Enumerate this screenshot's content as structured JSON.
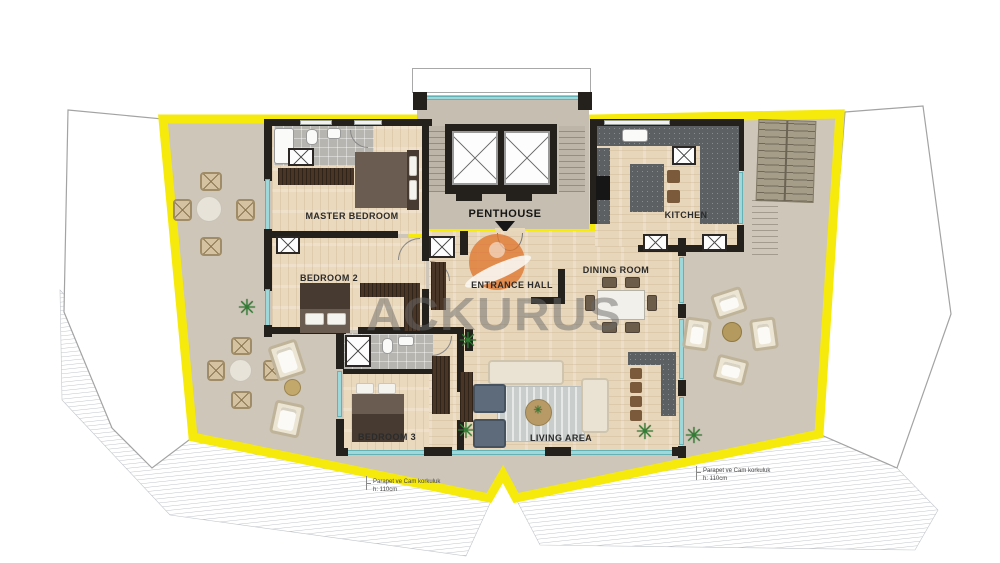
{
  "title": "Penthouse floor plan",
  "colors": {
    "yellow": "#F6EA0C",
    "terrace": "#CEC6B9",
    "wood": "#EAD9BD",
    "wall": "#24211D",
    "glass": "#9FD8DA",
    "counter": "#5C6063",
    "darkwood": "#4A3627",
    "orange": "#E0762F",
    "watermark": "rgba(105,105,105,0.5)",
    "plant": "#2F7D33"
  },
  "core": {
    "label": "PENTHOUSE"
  },
  "rooms": [
    {
      "id": "master-bedroom",
      "label": "MASTER BEDROOM"
    },
    {
      "id": "bedroom-2",
      "label": "BEDROOM 2"
    },
    {
      "id": "bedroom-3",
      "label": "BEDROOM 3"
    },
    {
      "id": "entrance-hall",
      "label": "ENTRANCE HALL"
    },
    {
      "id": "kitchen",
      "label": "KITCHEN"
    },
    {
      "id": "dining-room",
      "label": "DINING ROOM"
    },
    {
      "id": "living-area",
      "label": "LIVING AREA"
    }
  ],
  "annotations": [
    {
      "id": "parapet-left",
      "line1": "Parapet ve Cam korkuluk",
      "line2": "h: 110cm"
    },
    {
      "id": "parapet-right",
      "line1": "Parapet ve Cam korkuluk",
      "line2": "h: 110cm"
    }
  ],
  "watermark": {
    "text": "ACKURUS"
  },
  "icons": {
    "plant_glyph": "✳"
  }
}
